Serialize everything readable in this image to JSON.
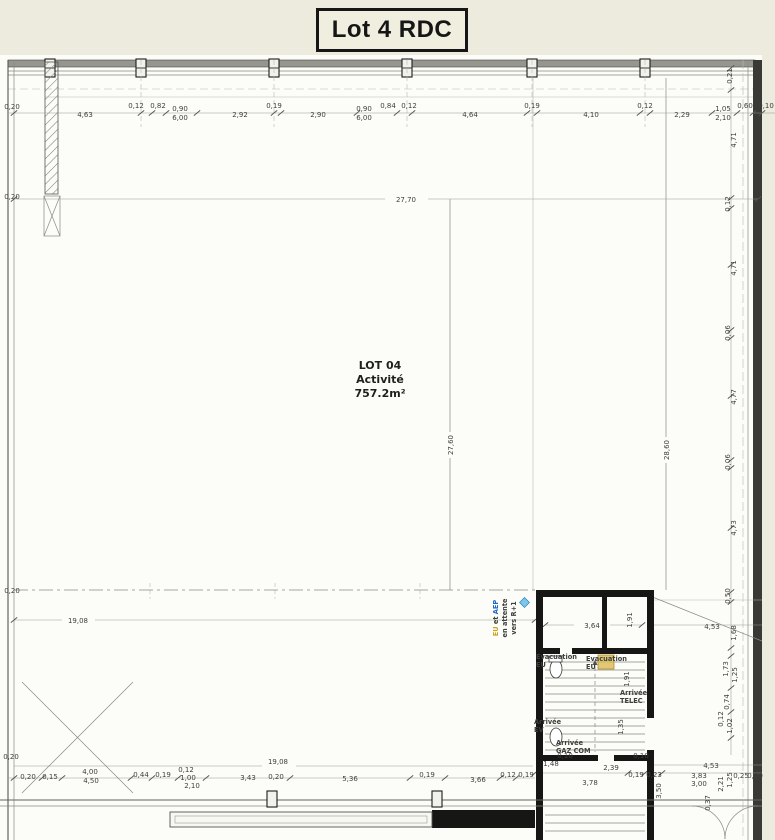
{
  "page": {
    "title": "Lot 4 RDC"
  },
  "room": {
    "name": "LOT 04",
    "use": "Activité",
    "area": "757.2m²"
  },
  "dims": {
    "left": [
      "0,20",
      "0,20",
      "0,20",
      "0,20"
    ],
    "top": [
      "4,63",
      "0,12",
      "0,82",
      "0,90",
      "6,00",
      "2,92",
      "0,19",
      "2,90",
      "0,90",
      "6,00",
      "0,84",
      "0,12",
      "4,64",
      "0,19",
      "4,10",
      "0,12",
      "2,29",
      "1,05",
      "2,10",
      "0,60",
      "0,10"
    ],
    "right": [
      "0,21",
      "4,71",
      "0,12",
      "4,71",
      "0,06",
      "4,77",
      "0,06",
      "4,73"
    ],
    "right_bottom": [
      "0,50",
      "4,53",
      "1,68",
      "1,73",
      "1,25",
      "0,74",
      "0,12",
      "1,02",
      "4,53",
      "3,83",
      "3,00",
      "2,21",
      "1,25",
      "0,25",
      "0,20",
      "3,50",
      "0,37"
    ],
    "interior": [
      "27,70",
      "27,60",
      "28,60",
      "19,08",
      "3,64",
      "1,91",
      "1,91",
      "1,35",
      "19,08",
      "1,48",
      "0,10",
      "2,39",
      "0,10",
      "3,78",
      "0,19",
      "0,23"
    ],
    "bottom": [
      "0,20",
      "0,15",
      "4,00",
      "4,50",
      "0,44",
      "0,19",
      "0,12",
      "1,00",
      "2,10",
      "3,43",
      "0,20",
      "5,36",
      "0,19",
      "3,66",
      "0,12",
      "0,19"
    ]
  },
  "annotations": {
    "colors": {
      "yellow": "#C9A320",
      "blue": "#1E66C9",
      "red": "#E01F1F",
      "green": "#1F9E4B"
    },
    "riser_line1_a": "EU",
    "riser_line1_b": " et ",
    "riser_line1_c": "AEP",
    "riser_line2": "en attente",
    "riser_line3": "vers R+1",
    "evac1_line1": "Evacuation",
    "evac1_line2": "EU",
    "evac2_line1": "Evacuation",
    "evac2_line2": "EU",
    "telec_line1": "Arrivée",
    "telec_line2": "TELEC",
    "ev_line1": "Arrivée",
    "ev_line2": "EV",
    "gaz_line1": "Arrivée",
    "gaz_line2": "GAZ COM"
  }
}
